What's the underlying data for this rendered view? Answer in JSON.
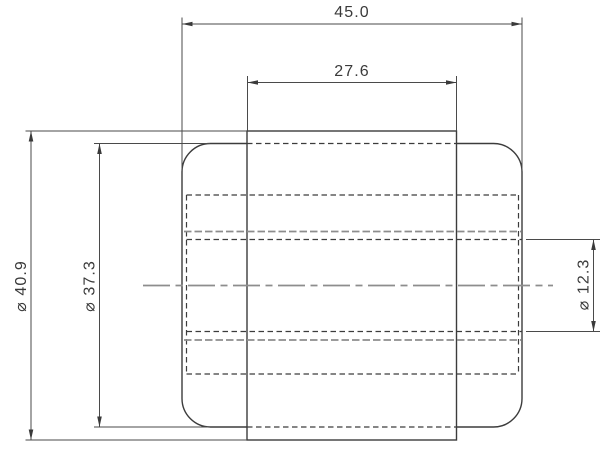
{
  "drawing": {
    "dimensions": {
      "overall_width": {
        "label": "45.0",
        "value": 45.0,
        "orientation": "horizontal"
      },
      "hub_width": {
        "label": "27.6",
        "value": 27.6,
        "orientation": "horizontal"
      },
      "outer_diameter": {
        "label": "⌀ 40.9",
        "value": 40.9,
        "orientation": "vertical"
      },
      "face_diameter": {
        "label": "⌀ 37.3",
        "value": 37.3,
        "orientation": "vertical"
      },
      "bore_diameter": {
        "label": "⌀ 12.3",
        "value": 12.3,
        "orientation": "vertical"
      }
    },
    "colors": {
      "background": "#ffffff",
      "line_dark": "#3c3c3c",
      "line_gray": "#8d8d8d",
      "text": "#3a3a3a"
    }
  }
}
